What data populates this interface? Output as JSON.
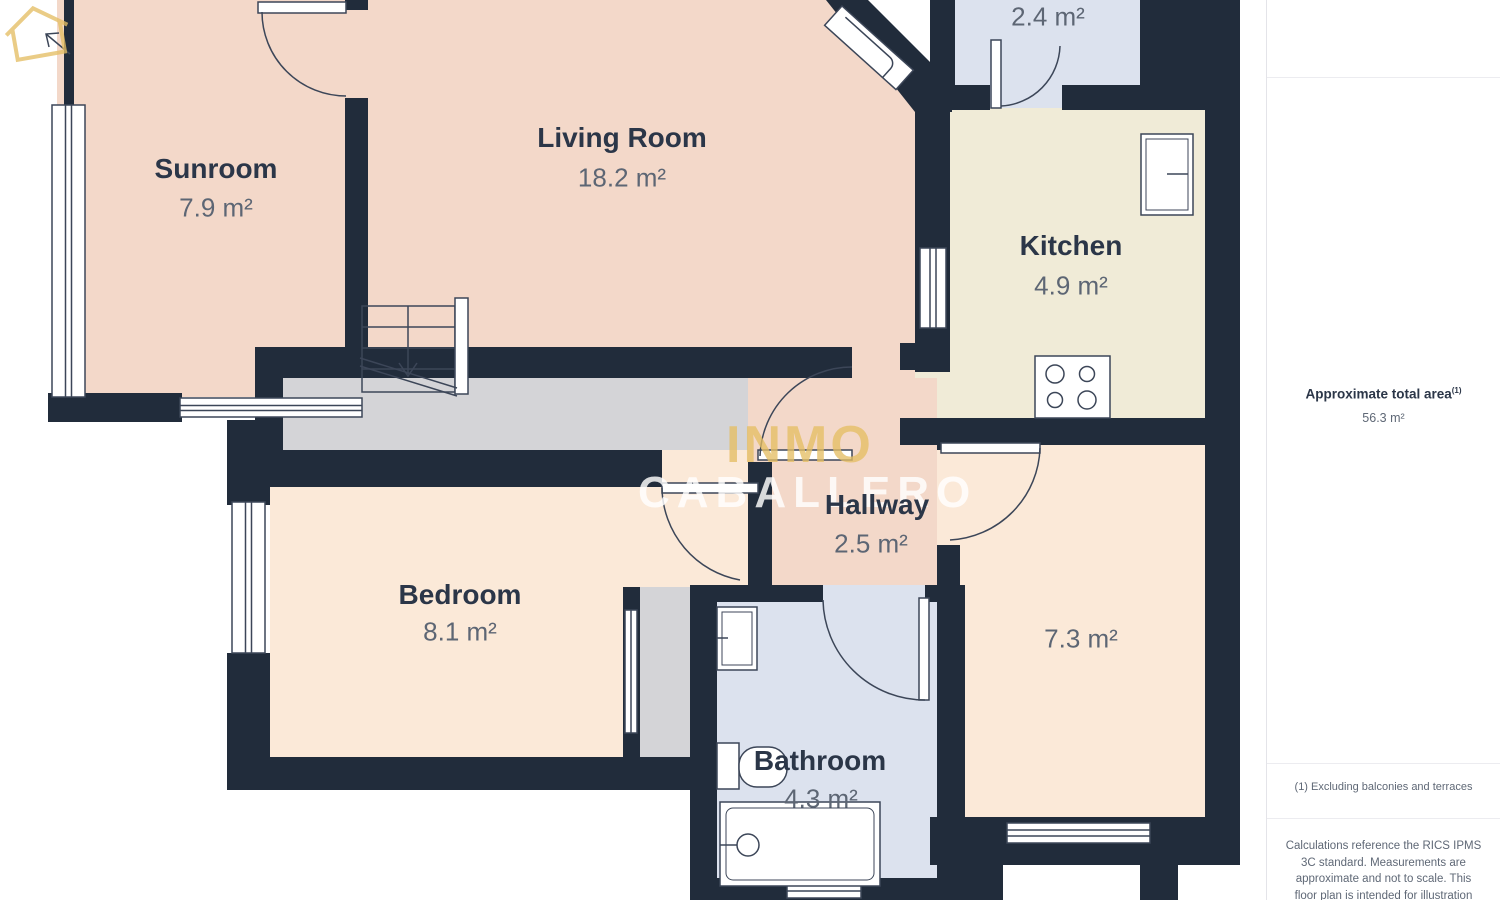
{
  "colors": {
    "wall": "#212c3b",
    "salmon": "#f3d8c9",
    "cream": "#f0ebd7",
    "peach": "#fbe9d8",
    "blue": "#dce2ee",
    "gray": "#d4d4d7",
    "white": "#ffffff",
    "gold": "#e0ba67"
  },
  "rooms": {
    "sunroom": {
      "name": "Sunroom",
      "area": "7.9 m²"
    },
    "living_room": {
      "name": "Living Room",
      "area": "18.2 m²"
    },
    "balcony": {
      "area": "2.4 m²"
    },
    "kitchen": {
      "name": "Kitchen",
      "area": "4.9 m²"
    },
    "hallway": {
      "name": "Hallway",
      "area": "2.5 m²"
    },
    "bedroom": {
      "name": "Bedroom",
      "area": "8.1 m²"
    },
    "bathroom": {
      "name": "Bathroom",
      "area": "4.3 m²"
    },
    "room_right": {
      "area": "7.3 m²"
    }
  },
  "watermark": {
    "brand_top": "INMO",
    "brand_bottom": "CABALLERO"
  },
  "sidebar": {
    "total_area_label": "Approximate total area",
    "total_area_footnote_marker": "(1)",
    "total_area_value": "56.3 m²",
    "footnote": "(1) Excluding balconies and terraces",
    "disclaimer": "Calculations reference the RICS IPMS 3C standard. Measurements are approximate and not to scale. This floor plan is intended for illustration"
  }
}
